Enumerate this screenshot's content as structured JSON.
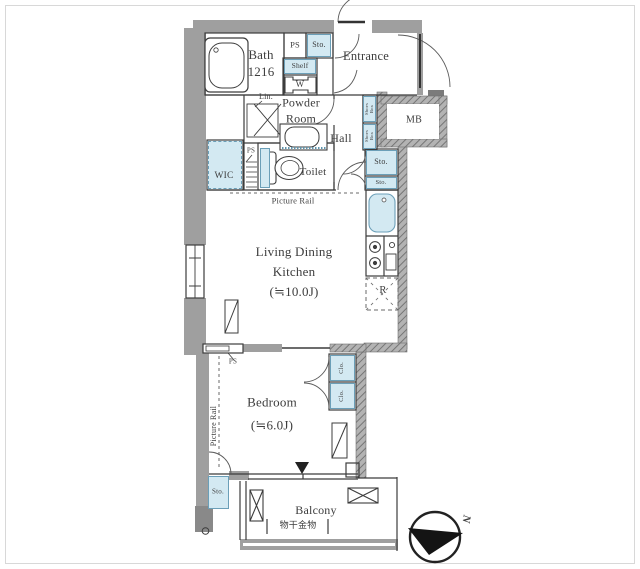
{
  "labels": {
    "bath": "Bath\n1216",
    "ps": "PS",
    "sto": "Sto.",
    "shelf": "Shelf",
    "washer": "W",
    "entrance": "Entrance",
    "lin": "Lin.",
    "powder_room": "Powder\nRoom",
    "hall": "Hall",
    "wic": "WIC",
    "toilet": "Toilet",
    "mb": "MB",
    "shoes_box": "Shoes\nBox",
    "picture_rail": "Picture Rail",
    "ldk": "Living Dining\nKitchen\n(≒10.0J)",
    "refrigerator": "R",
    "clo": "Clo.",
    "bedroom": "Bedroom\n(≒6.0J)",
    "balcony": "Balcony",
    "laundry_hardware": "物干金物",
    "north": "N"
  },
  "colors": {
    "fixture_blue": "#d3e9f2",
    "fixture_blue_border": "#6b9fb8",
    "wall_gray": "#9f9f9f",
    "line": "#3c3c3c"
  }
}
